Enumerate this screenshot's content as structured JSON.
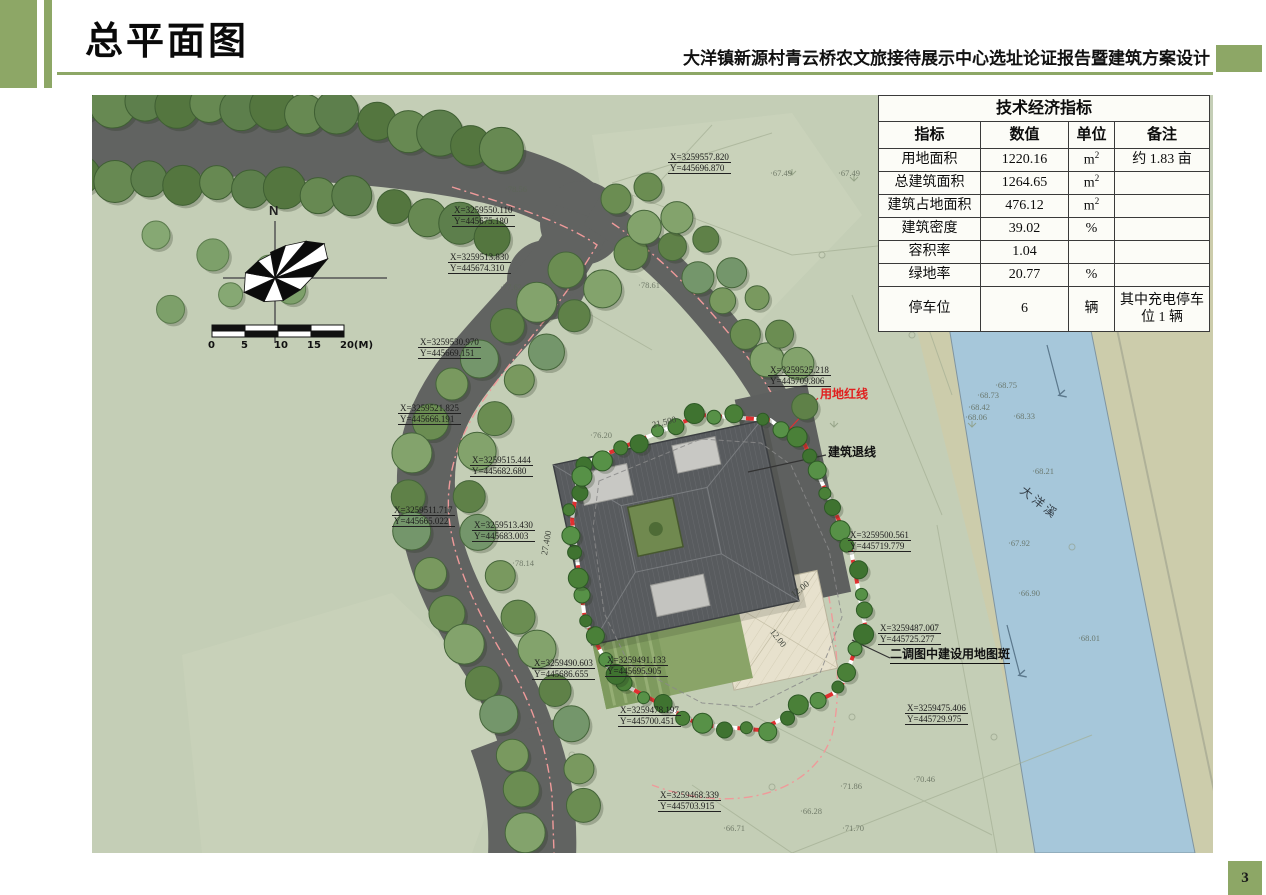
{
  "header": {
    "title": "总平面图",
    "subtitle": "大洋镇新源村青云桥农文旅接待展示中心选址论证报告暨建筑方案设计"
  },
  "page_number": "3",
  "colors": {
    "accent_green": "#8da766",
    "map_background": "#c4ceb6",
    "river_blue": "#a6c7da",
    "redline_red": "#e02020",
    "road_gray": "#616361"
  },
  "indicators_table": {
    "title": "技术经济指标",
    "columns": [
      "指标",
      "数值",
      "单位",
      "备注"
    ],
    "rows": [
      {
        "name": "用地面积",
        "value": "1220.16",
        "unit": "m2",
        "note": "约 1.83 亩"
      },
      {
        "name": "总建筑面积",
        "value": "1264.65",
        "unit": "m2",
        "note": ""
      },
      {
        "name": "建筑占地面积",
        "value": "476.12",
        "unit": "m2",
        "note": ""
      },
      {
        "name": "建筑密度",
        "value": "39.02",
        "unit": "%",
        "note": ""
      },
      {
        "name": "容积率",
        "value": "1.04",
        "unit": "",
        "note": ""
      },
      {
        "name": "绿地率",
        "value": "20.77",
        "unit": "%",
        "note": ""
      },
      {
        "name": "停车位",
        "value": "6",
        "unit": "辆",
        "note": "其中充电停车位 1 辆"
      }
    ]
  },
  "map": {
    "compass_north": "N",
    "scale_labels": [
      "0",
      "5",
      "10",
      "15",
      "20(M)"
    ],
    "river_name": "大洋溪",
    "annotations": {
      "redline": "用地红线",
      "setback": "建筑退线",
      "landuse_patch": "二调图中建设用地图斑"
    },
    "coordinate_labels": [
      {
        "x": 576,
        "y": 57,
        "X": "X=3259557.820",
        "Y": "Y=445696.870"
      },
      {
        "x": 360,
        "y": 110,
        "X": "X=3259550.110",
        "Y": "Y=445675.180"
      },
      {
        "x": 356,
        "y": 157,
        "X": "X=3259513.830",
        "Y": "Y=445674.310"
      },
      {
        "x": 326,
        "y": 242,
        "X": "X=3259530.970",
        "Y": "Y=445669.151"
      },
      {
        "x": 306,
        "y": 308,
        "X": "X=3259521.825",
        "Y": "Y=445666.191"
      },
      {
        "x": 378,
        "y": 360,
        "X": "X=3259515.444",
        "Y": "Y=445682.680"
      },
      {
        "x": 300,
        "y": 410,
        "X": "X=3259511.717",
        "Y": "Y=445665.022"
      },
      {
        "x": 380,
        "y": 425,
        "X": "X=3259513.430",
        "Y": "Y=445683.003"
      },
      {
        "x": 676,
        "y": 270,
        "X": "X=3259525.218",
        "Y": "Y=445709.806"
      },
      {
        "x": 756,
        "y": 435,
        "X": "X=3259500.561",
        "Y": "Y=445719.779"
      },
      {
        "x": 786,
        "y": 528,
        "X": "X=3259487.007",
        "Y": "Y=445725.277"
      },
      {
        "x": 440,
        "y": 563,
        "X": "X=3259490.603",
        "Y": "Y=445686.655"
      },
      {
        "x": 513,
        "y": 560,
        "X": "X=3259491.133",
        "Y": "Y=445695.905"
      },
      {
        "x": 526,
        "y": 610,
        "X": "X=3259478.197",
        "Y": "Y=445700.451"
      },
      {
        "x": 813,
        "y": 608,
        "X": "X=3259475.406",
        "Y": "Y=445729.975"
      },
      {
        "x": 566,
        "y": 695,
        "X": "X=3259468.339",
        "Y": "Y=445703.915"
      }
    ],
    "elevation_marks": [
      {
        "x": 413,
        "y": 89,
        "v": "78.56"
      },
      {
        "x": 678,
        "y": 73,
        "v": "67.49"
      },
      {
        "x": 746,
        "y": 73,
        "v": "67.49"
      },
      {
        "x": 546,
        "y": 185,
        "v": "78.61"
      },
      {
        "x": 408,
        "y": 187,
        "v": "77.62"
      },
      {
        "x": 498,
        "y": 335,
        "v": "76.20"
      },
      {
        "x": 420,
        "y": 463,
        "v": "78.14"
      },
      {
        "x": 903,
        "y": 285,
        "v": "68.75"
      },
      {
        "x": 885,
        "y": 295,
        "v": "68.73"
      },
      {
        "x": 876,
        "y": 307,
        "v": "68.42"
      },
      {
        "x": 873,
        "y": 317,
        "v": "68.06"
      },
      {
        "x": 921,
        "y": 316,
        "v": "68.33"
      },
      {
        "x": 940,
        "y": 371,
        "v": "68.21"
      },
      {
        "x": 916,
        "y": 443,
        "v": "67.92"
      },
      {
        "x": 926,
        "y": 493,
        "v": "66.90"
      },
      {
        "x": 986,
        "y": 538,
        "v": "68.01"
      },
      {
        "x": 821,
        "y": 679,
        "v": "70.46"
      },
      {
        "x": 748,
        "y": 686,
        "v": "71.86"
      },
      {
        "x": 708,
        "y": 711,
        "v": "66.28"
      },
      {
        "x": 631,
        "y": 728,
        "v": "66.71"
      },
      {
        "x": 750,
        "y": 728,
        "v": "71.70"
      }
    ],
    "dimension_labels": [
      {
        "x": 560,
        "y": 325,
        "rot": -14,
        "t": "21.500"
      },
      {
        "x": 452,
        "y": 455,
        "rot": -80,
        "t": "27.400"
      },
      {
        "x": 700,
        "y": 495,
        "rot": -38,
        "t": "12.00"
      },
      {
        "x": 680,
        "y": 530,
        "rot": 52,
        "t": "12.00"
      }
    ]
  }
}
